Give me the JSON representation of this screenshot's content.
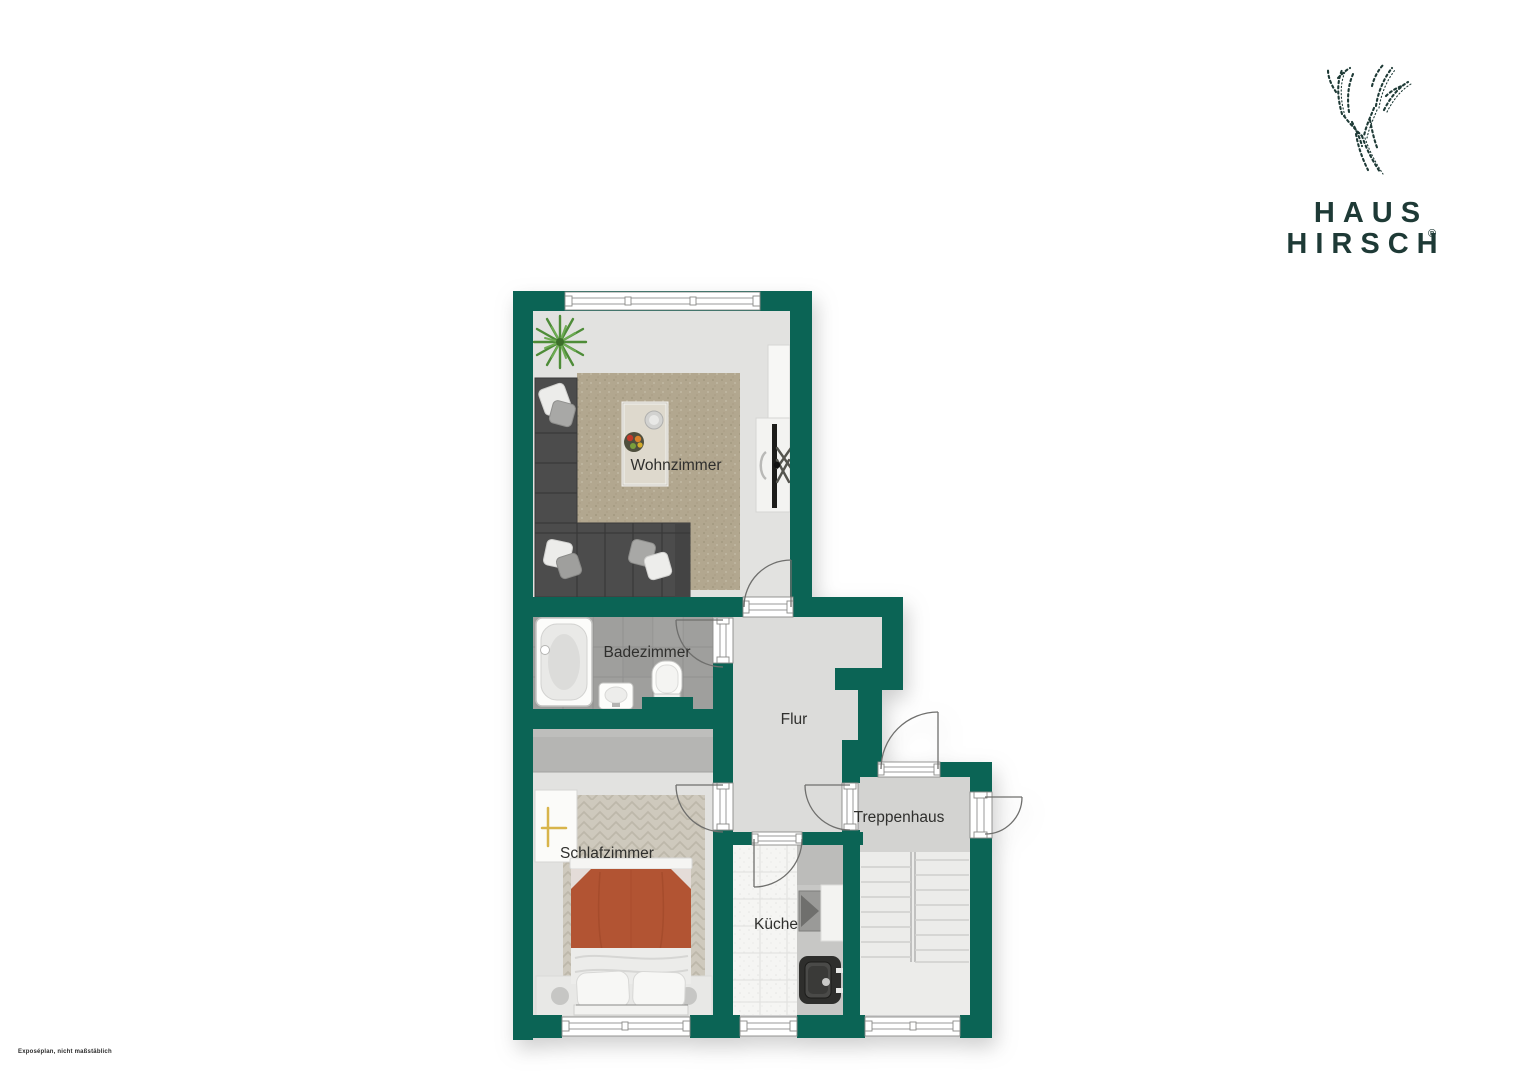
{
  "page": {
    "background_color": "#ffffff"
  },
  "branding": {
    "logo_icon": "deer-antlers-sketch",
    "line1": "HAUS",
    "line2": "HIRSCH",
    "registered_mark": "®",
    "color": "#1e3a36"
  },
  "floor_plan": {
    "rooms": [
      {
        "id": "wohnzimmer",
        "label": "Wohnzimmer",
        "furniture": [
          "corner-sofa",
          "throw-pillows",
          "coffee-table",
          "fruit-bowl",
          "rug",
          "sideboard",
          "tv",
          "plant"
        ]
      },
      {
        "id": "badezimmer",
        "label": "Badezimmer",
        "furniture": [
          "bathtub",
          "washbasin",
          "toilet"
        ]
      },
      {
        "id": "flur",
        "label": "Flur",
        "furniture": []
      },
      {
        "id": "schlafzimmer",
        "label": "Schlafzimmer",
        "furniture": [
          "wardrobe",
          "double-bed",
          "pillows",
          "rug",
          "bedside-shelf",
          "bench-with-stools"
        ]
      },
      {
        "id": "kueche",
        "label": "Küche",
        "furniture": [
          "kitchen-counter",
          "stove",
          "kitchen-sink"
        ]
      },
      {
        "id": "treppenhaus",
        "label": "Treppenhaus",
        "furniture": [
          "staircase",
          "landing"
        ]
      }
    ],
    "colors": {
      "wall": "#0b6455",
      "living_floor": "#e2e2e0",
      "hallway_floor": "#dcdcda",
      "bath_tile": "#9f9f9d",
      "kitchen_floor": "#f5f5f3",
      "stair_landing": "#d3d3d1",
      "living_rug": "#b2a78f",
      "bedroom_rug": "#cec9bd",
      "bed_duvet": "#b25433",
      "sofa": "#4c4c4c"
    }
  },
  "footnote": {
    "text": "Exposéplan, nicht maßstäblich"
  }
}
